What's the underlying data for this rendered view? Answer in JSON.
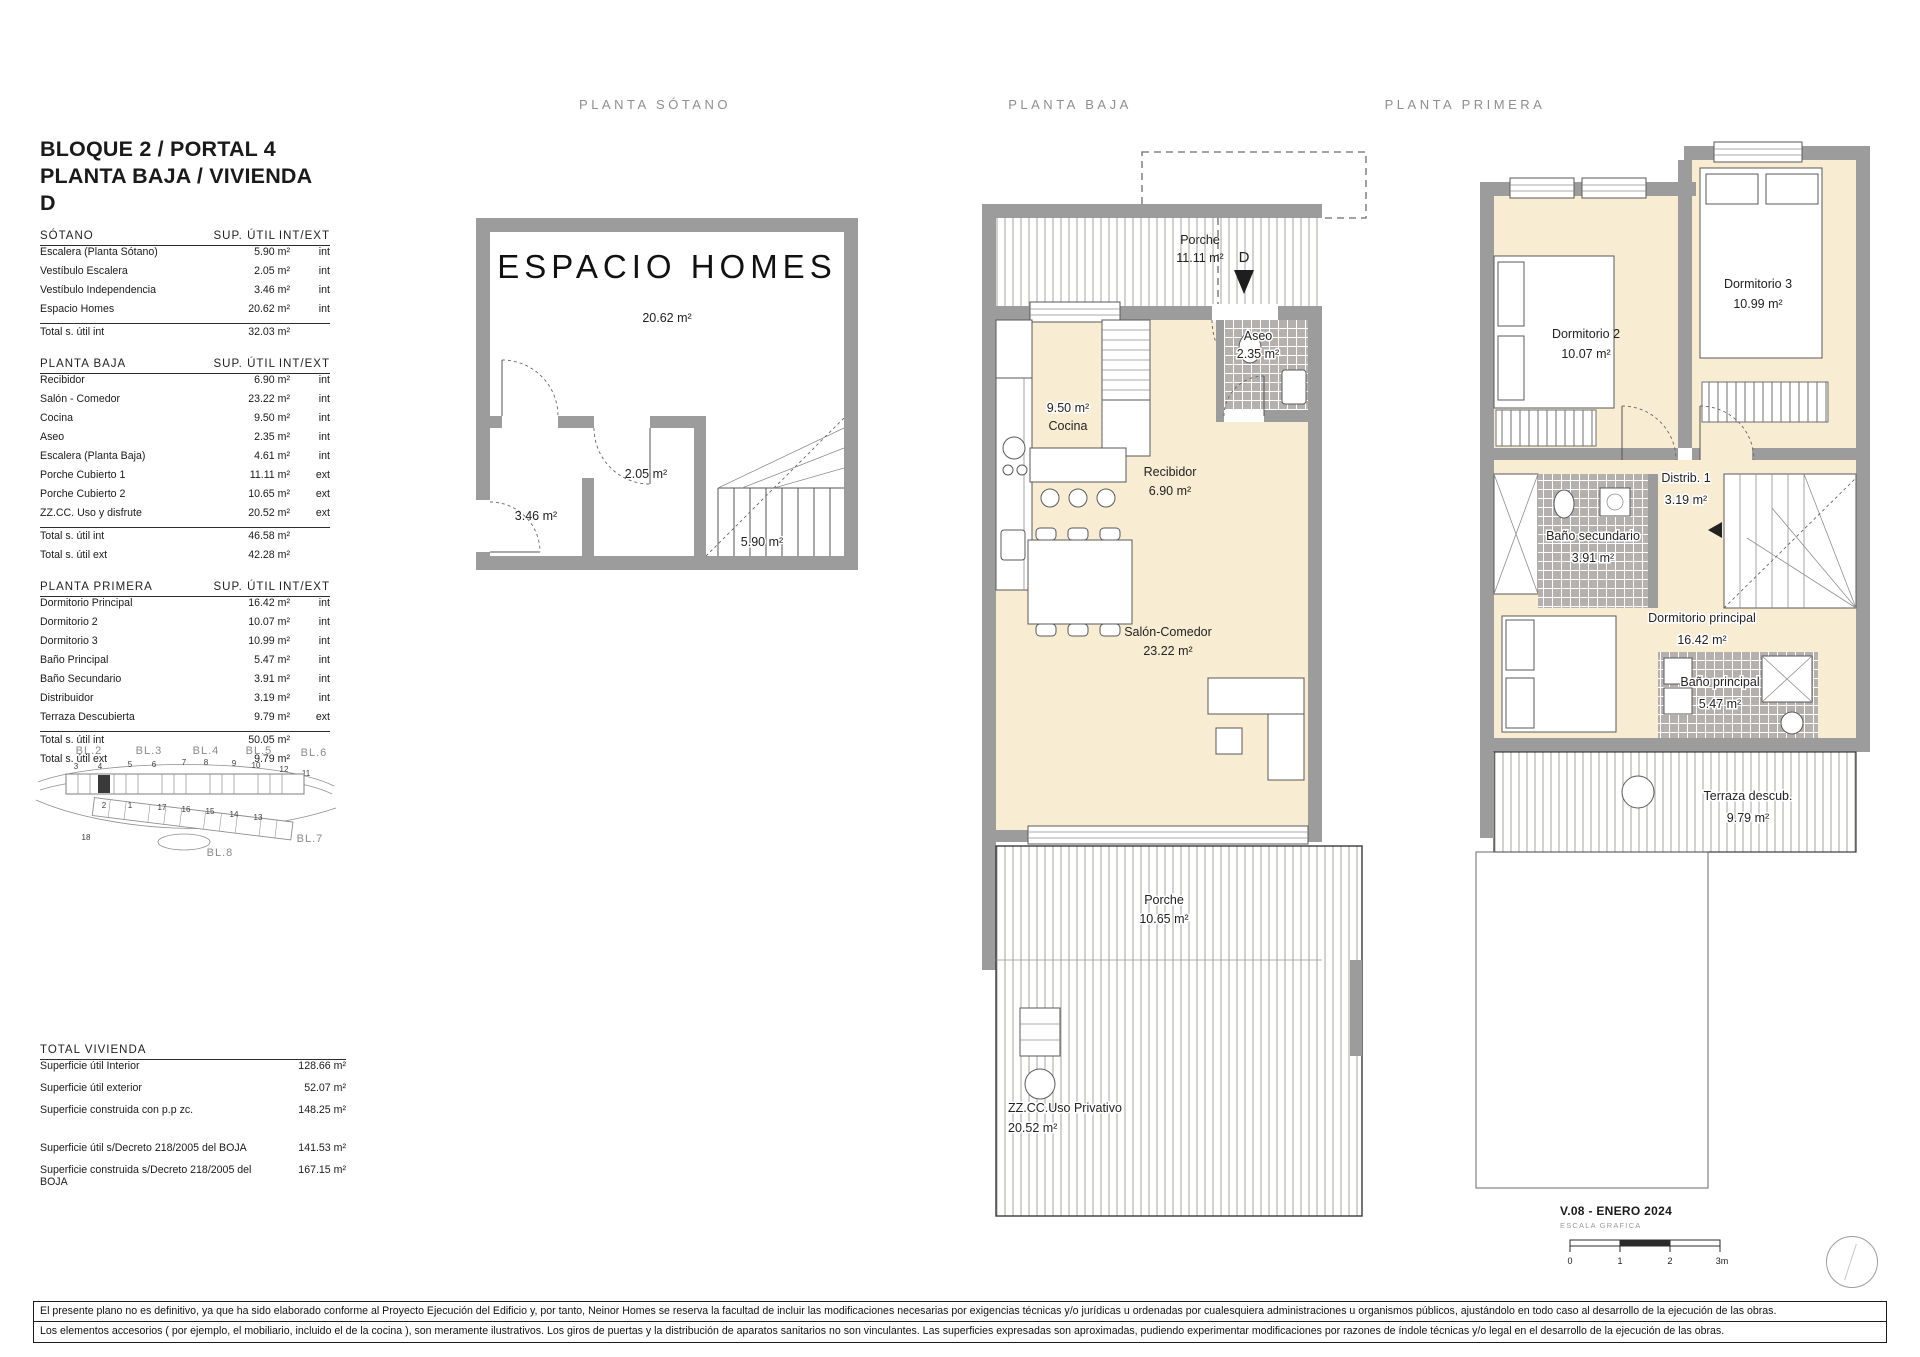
{
  "header": {
    "block_title_1": "BLOQUE 2 / PORTAL 4",
    "block_title_2": "PLANTA BAJA / VIVIENDA D"
  },
  "columns": {
    "sotano": "PLANTA SÓTANO",
    "baja": "PLANTA BAJA",
    "primera": "PLANTA PRIMERA"
  },
  "tables": {
    "sotano": {
      "section": "SÓTANO",
      "col1": "SUP. ÚTIL",
      "col2": "INT/EXT",
      "rows": [
        {
          "name": "Escalera (Planta Sótano)",
          "area": "5.90 m²",
          "type": "int"
        },
        {
          "name": "Vestíbulo Escalera",
          "area": "2.05 m²",
          "type": "int"
        },
        {
          "name": "Vestíbulo Independencia",
          "area": "3.46 m²",
          "type": "int"
        },
        {
          "name": "Espacio Homes",
          "area": "20.62 m²",
          "type": "int"
        }
      ],
      "totals": [
        {
          "label": "Total s. útil int",
          "value": "32.03 m²"
        }
      ]
    },
    "baja": {
      "section": "PLANTA BAJA",
      "col1": "SUP. ÚTIL",
      "col2": "INT/EXT",
      "rows": [
        {
          "name": "Recibidor",
          "area": "6.90 m²",
          "type": "int"
        },
        {
          "name": "Salón - Comedor",
          "area": "23.22 m²",
          "type": "int"
        },
        {
          "name": "Cocina",
          "area": "9.50 m²",
          "type": "int"
        },
        {
          "name": "Aseo",
          "area": "2.35 m²",
          "type": "int"
        },
        {
          "name": "Escalera (Planta Baja)",
          "area": "4.61 m²",
          "type": "int"
        },
        {
          "name": "Porche Cubierto 1",
          "area": "11.11 m²",
          "type": "ext"
        },
        {
          "name": "Porche Cubierto 2",
          "area": "10.65 m²",
          "type": "ext"
        },
        {
          "name": "ZZ.CC. Uso y disfrute",
          "area": "20.52 m²",
          "type": "ext"
        }
      ],
      "totals": [
        {
          "label": "Total s. útil int",
          "value": "46.58 m²"
        },
        {
          "label": "Total s. útil ext",
          "value": "42.28 m²"
        }
      ]
    },
    "primera": {
      "section": "PLANTA PRIMERA",
      "col1": "SUP. ÚTIL",
      "col2": "INT/EXT",
      "rows": [
        {
          "name": "Dormitorio Principal",
          "area": "16.42 m²",
          "type": "int"
        },
        {
          "name": "Dormitorio 2",
          "area": "10.07 m²",
          "type": "int"
        },
        {
          "name": "Dormitorio 3",
          "area": "10.99 m²",
          "type": "int"
        },
        {
          "name": "Baño Principal",
          "area": "5.47 m²",
          "type": "int"
        },
        {
          "name": "Baño Secundario",
          "area": "3.91 m²",
          "type": "int"
        },
        {
          "name": "Distribuidor",
          "area": "3.19 m²",
          "type": "int"
        },
        {
          "name": "Terraza Descubierta",
          "area": "9.79 m²",
          "type": "ext"
        }
      ],
      "totals": [
        {
          "label": "Total s. útil int",
          "value": "50.05 m²"
        },
        {
          "label": "Total s. útil ext",
          "value": "9.79 m²"
        }
      ]
    },
    "total": {
      "section": "TOTAL VIVIENDA",
      "rows": [
        {
          "label": "Superficie útil Interior",
          "value": "128.66 m²"
        },
        {
          "label": "Superficie útil exterior",
          "value": "52.07 m²"
        },
        {
          "label": "Superficie construida con p.p zc.",
          "value": "148.25 m²"
        }
      ],
      "rows2": [
        {
          "label": "Superficie útil s/Decreto 218/2005 del BOJA",
          "value": "141.53 m²"
        },
        {
          "label": "Superficie construida s/Decreto 218/2005 del BOJA",
          "value": "167.15 m²"
        }
      ]
    }
  },
  "siteplan": {
    "blocks": [
      "BL.2",
      "BL.3",
      "BL.4",
      "BL.5",
      "BL.6",
      "BL.7",
      "BL.8"
    ],
    "units_top": [
      "3",
      "4",
      "5",
      "6",
      "7",
      "8",
      "9",
      "10",
      "12",
      "11"
    ],
    "units_bottom": [
      "2",
      "1",
      "17",
      "16",
      "15",
      "14",
      "13",
      "18"
    ]
  },
  "plans": {
    "sotano": {
      "brand": "ESPACIO HOMES",
      "espacio_area": "20.62 m²",
      "vestibulo_indep_area": "3.46 m²",
      "vestibulo_esc_area": "2.05 m²",
      "escalera_area": "5.90 m²"
    },
    "baja": {
      "porche_top_name": "Porche",
      "porche_top_area": "11.11 m²",
      "door_marker": "D",
      "aseo_name": "Aseo",
      "aseo_area": "2.35 m²",
      "cocina_name": "Cocina",
      "cocina_area": "9.50 m²",
      "recibidor_name": "Recibidor",
      "recibidor_area": "6.90 m²",
      "salon_name": "Salón-Comedor",
      "salon_area": "23.22 m²",
      "porche_bottom_name": "Porche",
      "porche_bottom_area": "10.65 m²",
      "zzcc_name": "ZZ.CC.Uso Privativo",
      "zzcc_area": "20.52 m²"
    },
    "primera": {
      "dorm2_name": "Dormitorio 2",
      "dorm2_area": "10.07 m²",
      "dorm3_name": "Dormitorio 3",
      "dorm3_area": "10.99 m²",
      "distrib_name": "Distrib. 1",
      "distrib_area": "3.19 m²",
      "bano_sec_name": "Baño secundario",
      "bano_sec_area": "3.91 m²",
      "dorm_ppal_name": "Dormitorio principal",
      "dorm_ppal_area": "16.42 m²",
      "bano_ppal_name": "Baño principal",
      "bano_ppal_area": "5.47 m²",
      "terraza_name": "Terraza descub.",
      "terraza_area": "9.79 m²"
    }
  },
  "footer": {
    "version": "V.08 - ENERO 2024",
    "scale_label": "ESCALA GRAFICA",
    "tick0": "0",
    "tick1": "1",
    "tick2": "2",
    "tick3": "3m"
  },
  "disclaimer": {
    "line1": "El presente plano no es definitivo, ya que ha sido elaborado conforme al Proyecto Ejecución del Edificio y, por tanto, Neinor Homes se reserva la facultad de incluir las modificaciones necesarias por exigencias técnicas y/o jurídicas u ordenadas por cualesquiera administraciones u organismos públicos, ajustándolo en todo caso al desarrollo de la ejecución de las obras.",
    "line2": "Los elementos accesorios  ( por ejemplo, el mobiliario, incluido el de la cocina ),  son meramente ilustrativos.  Los giros de puertas  y  la distribución de aparatos sanitarios no son vinculantes.  Las superficies  expresadas son aproximadas,  pudiendo  experimentar modificaciones por razones de índole técnicas y/o legal en el desarrollo de la ejecución de las obras."
  }
}
